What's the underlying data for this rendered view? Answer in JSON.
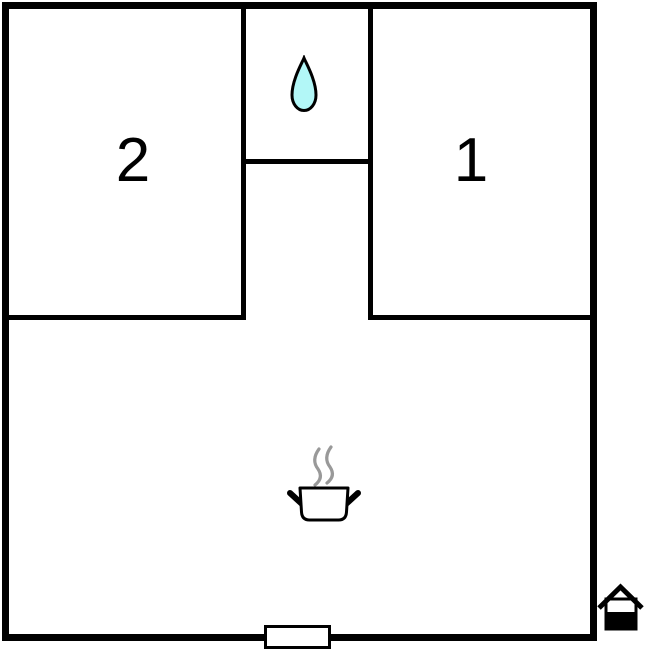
{
  "floorplan": {
    "background": "#ffffff",
    "wall_color": "#000000",
    "rooms": [
      {
        "id": "bedroom-2",
        "label": "2"
      },
      {
        "id": "bedroom-1",
        "label": "1"
      },
      {
        "id": "bathroom",
        "label": ""
      },
      {
        "id": "living-kitchen",
        "label": ""
      }
    ],
    "icons": {
      "water_drop": {
        "name": "water-drop-icon",
        "fill": "#b2f7f7",
        "outline": "#000000"
      },
      "cooking_pot": {
        "name": "cooking-pot-icon",
        "fill": "#ffffff",
        "outline": "#000000",
        "steam_color": "#999999"
      },
      "door": {
        "name": "door-marker",
        "fill": "#ffffff",
        "outline": "#000000"
      },
      "house": {
        "name": "house-icon",
        "color": "#000000"
      }
    }
  }
}
